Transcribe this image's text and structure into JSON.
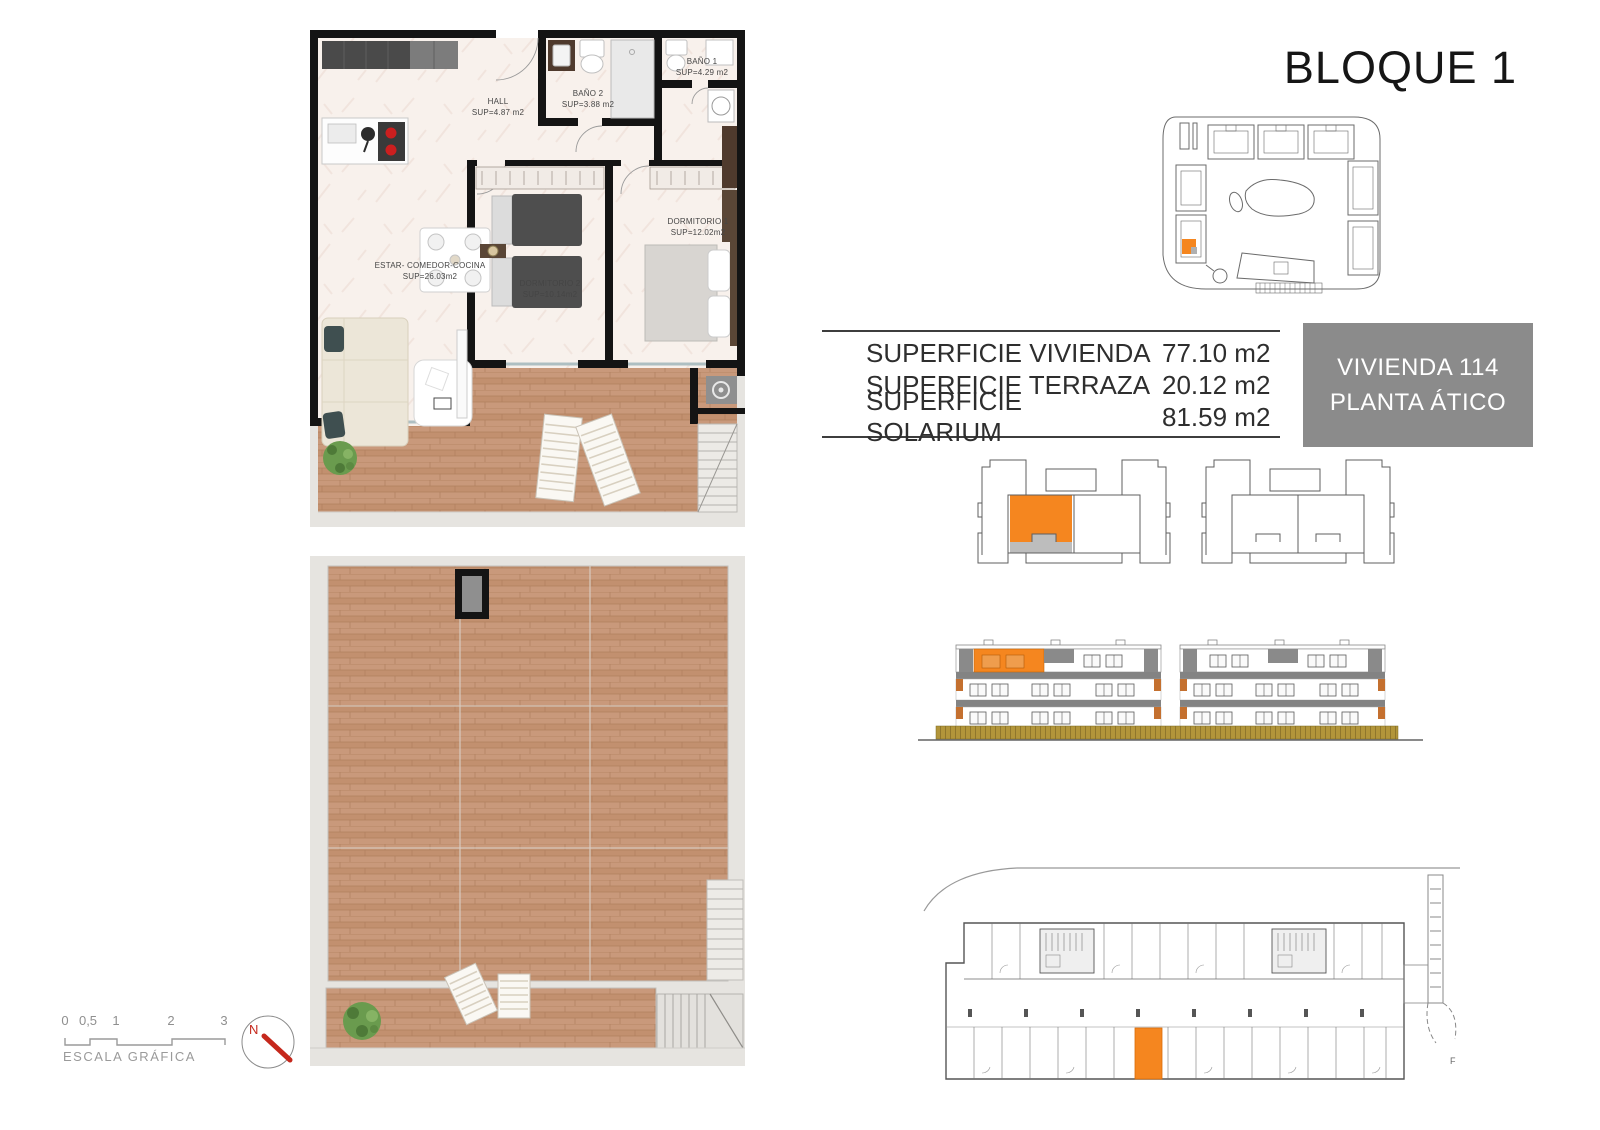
{
  "page": {
    "title": "BLOQUE 1",
    "sheet_mark": "F"
  },
  "info_box": {
    "line1": "VIVIENDA 114",
    "line2": "PLANTA ÁTICO"
  },
  "surface_table": {
    "rows": [
      {
        "label": "SUPERFICIE VIVIENDA",
        "value": "77.10 m2"
      },
      {
        "label": "SUPERFICIE TERRAZA",
        "value": "20.12 m2"
      },
      {
        "label": "SUPERFICIE SOLARIUM",
        "value": "81.59 m2"
      }
    ]
  },
  "floor_plan": {
    "rooms": [
      {
        "name": "HALL",
        "area": "SUP=4.87 m2"
      },
      {
        "name": "BAÑO 2",
        "area": "SUP=3.88 m2"
      },
      {
        "name": "BAÑO 1",
        "area": "SUP=4.29 m2"
      },
      {
        "name": "DORMITORIO 1",
        "area": "SUP=12.02m2"
      },
      {
        "name": "DORMITORIO 2",
        "area": "SUP=10.14m2"
      },
      {
        "name": "ESTAR- COMEDOR-COCINA",
        "area": "SUP=26.03m2"
      }
    ]
  },
  "scale_bar": {
    "labels": [
      "0",
      "0,5",
      "1",
      "2",
      "3"
    ],
    "caption": "ESCALA GRÁFICA"
  },
  "compass": {
    "label": "N"
  },
  "colors": {
    "accent_orange": "#f5861f",
    "terracotta_accent": "#c4702f",
    "info_box_gray": "#8b8b8b",
    "wall_black": "#141414",
    "wood_floor": "#c9997b",
    "marble_floor": "#f8f1ec",
    "concrete": "#e6e4e0",
    "fence_olive": "#b2953a",
    "compass_red": "#c5281c"
  }
}
